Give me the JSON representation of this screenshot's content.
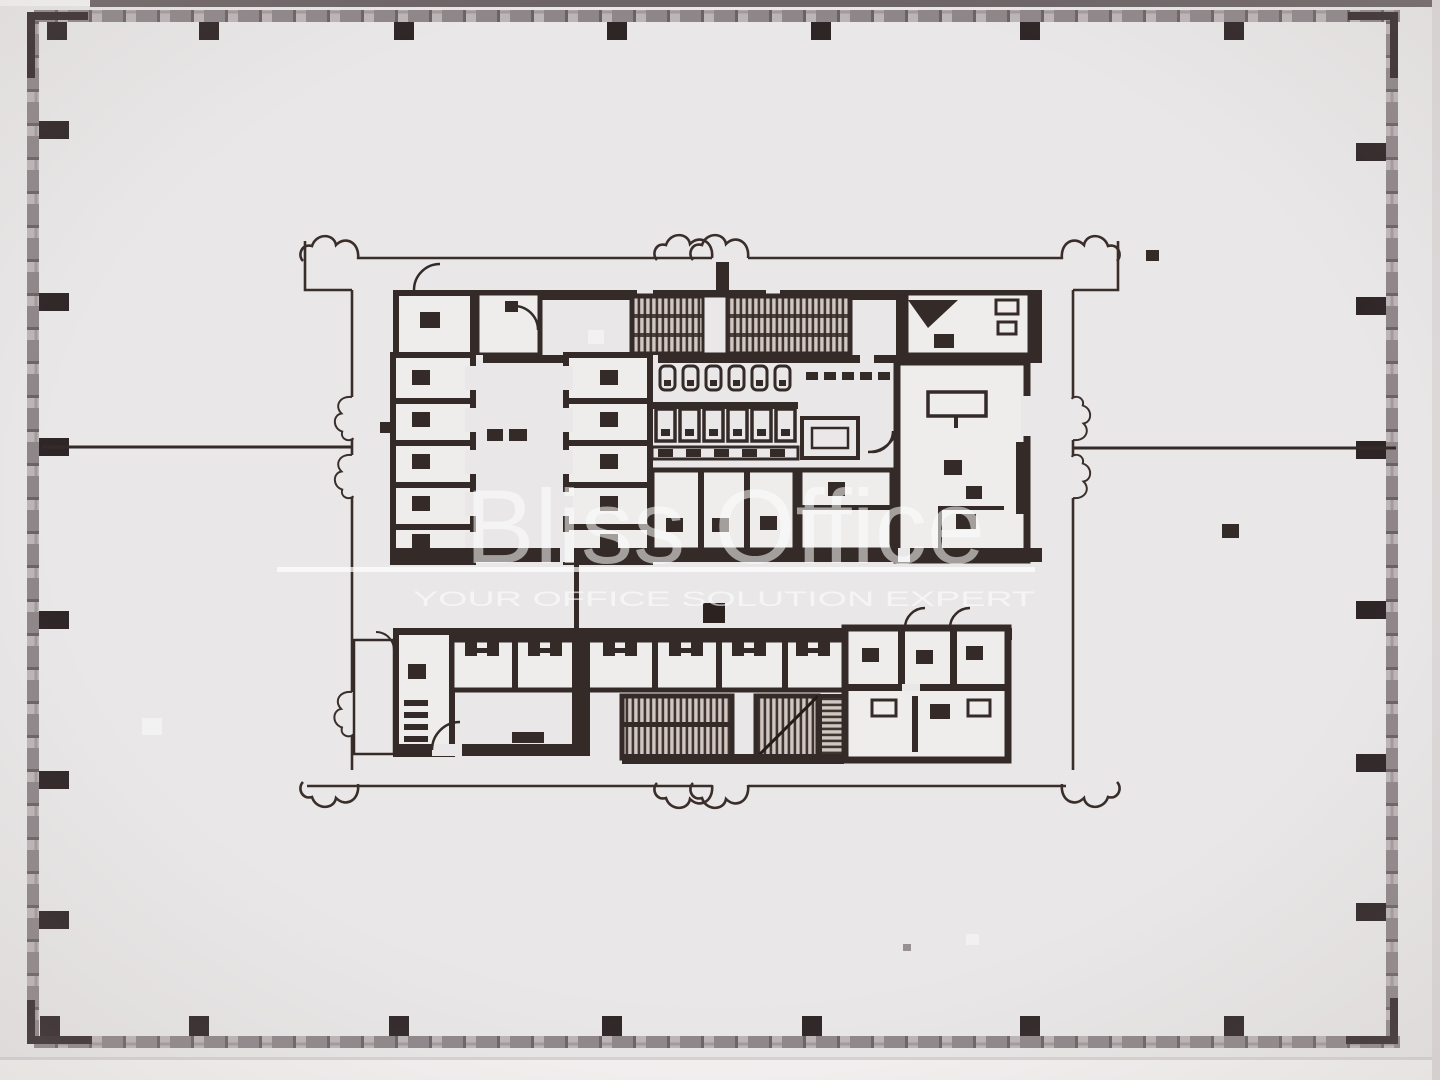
{
  "watermark": {
    "brand": "Bliss Office",
    "tagline": "YOUR OFFICE SOLUTION EXPERT",
    "text_color": "#ffffff"
  },
  "plan": {
    "paper_color": "#e9e7e8",
    "ink_color": "#342a27",
    "curtain_wall_color": "#8e8689",
    "stair_hatch_color": "#43332e",
    "features": [
      "perimeter-curtain-wall-with-mullions",
      "structural-column-grid",
      "tenant-demising-lines",
      "core-envelope-with-revision-cloud-breaks",
      "elevator-banks",
      "scissor-stairwells",
      "restrooms-with-stalls-and-sinks",
      "mechanical-room",
      "service-lobby"
    ]
  }
}
